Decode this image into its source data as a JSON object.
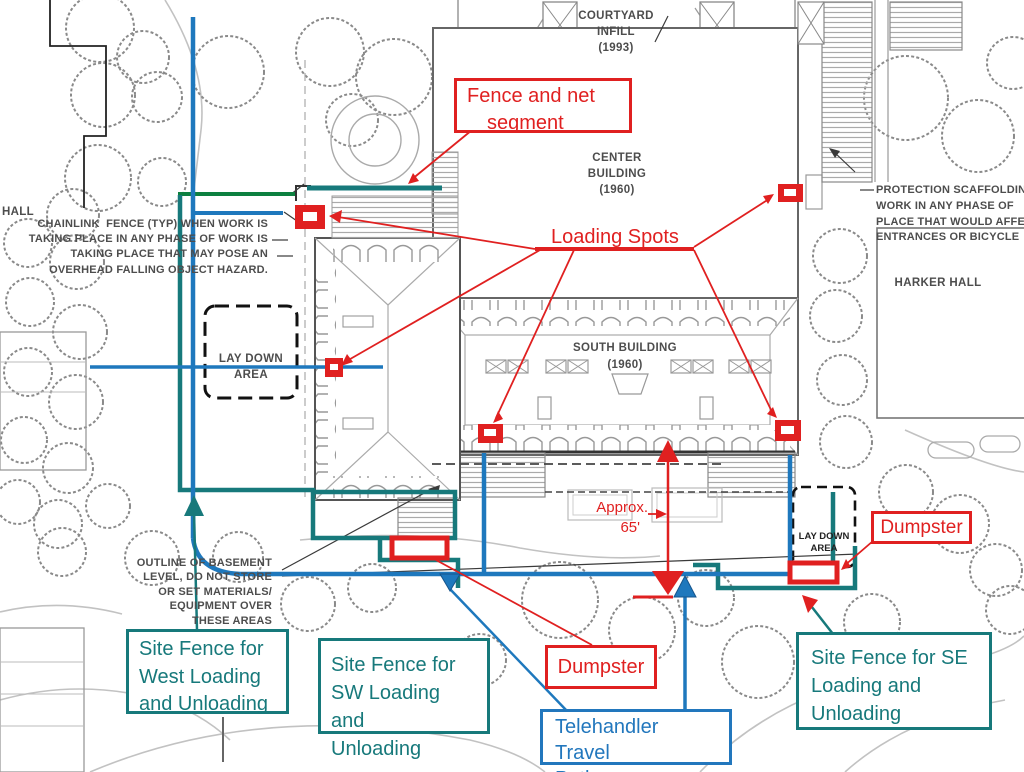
{
  "colors": {
    "annotation_red": "#e02020",
    "fence_teal": "#17797b",
    "path_blue": "#1e78bd",
    "fence_green": "#0d8040",
    "plan_gray": "#999999",
    "plan_dark": "#444444"
  },
  "plan": {
    "hall_label": "HALL",
    "courtyard_infill": [
      "COURTYARD",
      "INFILL",
      "(1993)"
    ],
    "center_building": [
      "CENTER",
      "BUILDING",
      "(1960)"
    ],
    "south_building": [
      "SOUTH BUILDING",
      "(1960)"
    ],
    "harker_hall": "HARKER HALL",
    "laydown_west": [
      "LAY DOWN",
      "AREA"
    ],
    "laydown_se": [
      "LAY DOWN",
      "AREA"
    ],
    "chainlink_note": [
      "CHAINLINK  FENCE (TYP) WHEN WORK IS",
      "TAKING PLACE IN ANY PHASE OF WORK IS",
      "TAKING PLACE THAT MAY POSE AN",
      "OVERHEAD FALLING OBJECT HAZARD."
    ],
    "protection_note": [
      "PROTECTION SCAFFOLDIN",
      "WORK IN ANY PHASE OF",
      "PLACE THAT WOULD AFFE",
      "ENTRANCES OR BICYCLE"
    ],
    "basement_note": [
      "OUTLINE OF BASEMENT",
      "LEVEL, DO NOT STORE",
      "OR SET MATERIALS/",
      "EQUIPMENT OVER",
      "THESE AREAS"
    ]
  },
  "annotations": {
    "fence_net": [
      "Fence and net",
      "segment"
    ],
    "loading_spots": "Loading Spots",
    "approx_distance": [
      "Approx.",
      "65'"
    ],
    "dumpster_sw": "Dumpster",
    "dumpster_se": "Dumpster",
    "site_fence_west": [
      "Site Fence for",
      "West Loading",
      "and Unloading"
    ],
    "site_fence_sw": [
      "Site Fence for",
      "SW Loading and",
      "Unloading"
    ],
    "site_fence_se": [
      "Site Fence for SE",
      "Loading and",
      "Unloading"
    ],
    "telehandler": [
      "Telehandler Travel",
      "Path"
    ]
  }
}
